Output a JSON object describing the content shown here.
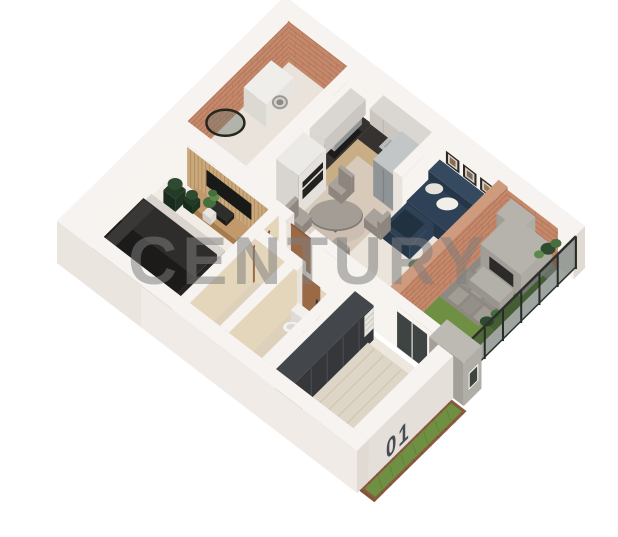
{
  "scene": {
    "title": "isometric-apartment-floorplan-3d-render",
    "background": "#ffffff",
    "elements": [
      "laundry-room",
      "kitchen",
      "living-dining-room",
      "master-bedroom",
      "hallway",
      "bathroom",
      "toilet",
      "second-bedroom",
      "patio-garden",
      "barbecue",
      "glass-fence",
      "entry-portal",
      "exterior-garden-strip",
      "unit-number",
      "watermark"
    ]
  },
  "watermark": {
    "text": "CENTURY",
    "color": "#7e7e7e",
    "opacity": 0.52
  },
  "unit_label": {
    "text": "01",
    "color": "#474c52"
  },
  "palette": {
    "wall_top": "#f6f3f0",
    "wall_in": "#f7f3ef",
    "wall_shade": "#e9e3dd",
    "wall_out_sw": "#f0ebe6",
    "wall_out_se": "#e5dfd9",
    "wall_side": "#e0dad3",
    "brick": "#c4886b",
    "brick_top": "#cf9b7e",
    "brick_line": "#a05f45",
    "floor_laundry": "#e9e3dc",
    "floor_kitchen": "#d7cabb",
    "floor_living": "#ebe4da",
    "floor_bed1": "#f1ece5",
    "floor_hall": "#e8e1d7",
    "floor_wc": "#ddd1bc",
    "floor_bed2": "#ede7de",
    "tan": "#e4d6ba",
    "tan_shade": "#d7c6a6",
    "counter_wood": "#c9ae85",
    "counter_wood_dark": "#b3946c",
    "counter_top": "#35322f",
    "upper": "#dad6d1",
    "upper_shade": "#cbc6c0",
    "steel": "#a7abac",
    "steel_dark": "#8f9496",
    "steel_top": "#c3c6c6",
    "sofa": "#2e4156",
    "sofa_dark": "#253649",
    "sofa_top": "#35495f",
    "pillow": "#f2efe9",
    "table_top": "#a39d96",
    "table_rim": "#817c76",
    "chair": "#a9a29a",
    "chair_dark": "#8e867e",
    "wood": "#b98a5c",
    "wood_dark": "#9d7044",
    "door": "#9a6a47",
    "door_dark": "#875a3a",
    "panel_wood": "#c9a87c",
    "slat_line": "#a8824f",
    "tv": "#191917",
    "oven": "#232221",
    "bed_dark": "#2f2d2b",
    "bed_darker": "#1c1b1a",
    "bed_light": "#ddd5c6",
    "bed_stripe": "#cdc2ae",
    "wardrobe": "#35373b",
    "wardrobe_top": "#43464b",
    "wardrobe_line": "#4c4f55",
    "plant_dark": "#2e4a31",
    "plant": "#456f3e",
    "plant_light": "#5d8a4a",
    "pot_dark": "#233a26",
    "grass": "#6f9042",
    "grass_dark": "#5d7c35",
    "paver": "#8e8a83",
    "stone_a": "#a19c94",
    "stone_b": "#948f88",
    "concrete": "#b6b2ac",
    "concrete_dark": "#a19d97",
    "concrete_top": "#c2beb8",
    "bbq_dark": "#2c2b29",
    "glass": "rgba(40,56,46,0.45)",
    "fence_post": "#272a26",
    "soil": "#8a5a3f",
    "white_goods": "#f0eeea"
  }
}
